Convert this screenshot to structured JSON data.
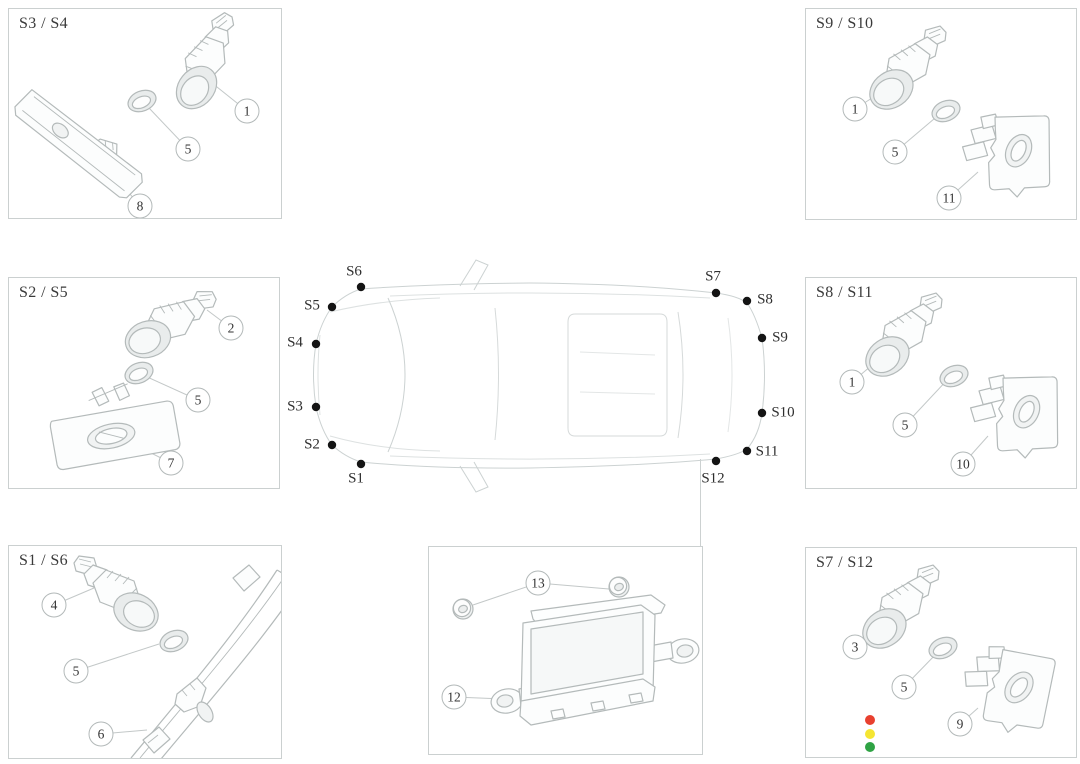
{
  "panels": {
    "s3s4": {
      "label": "S3 / S4",
      "callouts": [
        "1",
        "5",
        "8"
      ]
    },
    "s9s10": {
      "label": "S9 / S10",
      "callouts": [
        "1",
        "5",
        "11"
      ]
    },
    "s2s5": {
      "label": "S2 / S5",
      "callouts": [
        "2",
        "5",
        "7"
      ]
    },
    "s8s11": {
      "label": "S8 / S11",
      "callouts": [
        "1",
        "5",
        "10"
      ]
    },
    "s1s6": {
      "label": "S1 / S6",
      "callouts": [
        "4",
        "5",
        "6"
      ]
    },
    "module": {
      "callouts": [
        "13",
        "12"
      ]
    },
    "s7s12": {
      "label": "S7 / S12",
      "callouts": [
        "3",
        "5",
        "9"
      ]
    }
  },
  "car": {
    "sensor_labels": [
      "S1",
      "S2",
      "S3",
      "S4",
      "S5",
      "S6",
      "S7",
      "S8",
      "S9",
      "S10",
      "S11",
      "S12"
    ]
  },
  "legend": {
    "dot_colors": [
      "#e8402f",
      "#f5e532",
      "#2fa344"
    ]
  }
}
